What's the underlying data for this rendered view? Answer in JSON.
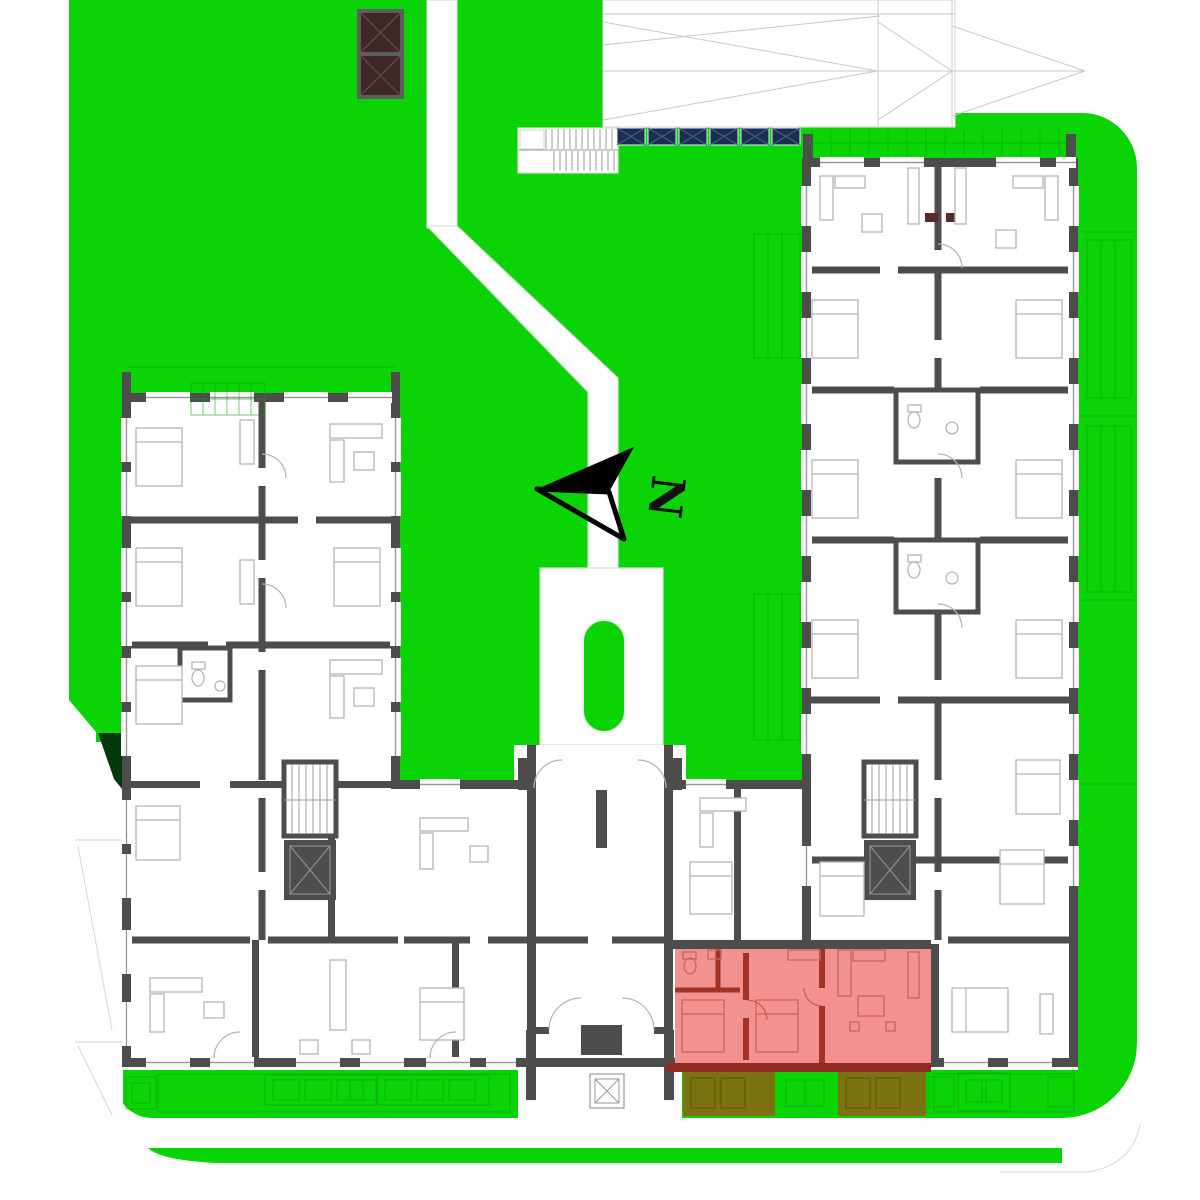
{
  "compass": {
    "label": "N",
    "direction": "pointing-left"
  },
  "highlighted_unit": {
    "highlighted": true,
    "rooms": [
      "bathroom",
      "bedroom",
      "bedroom",
      "living-room"
    ],
    "terrace_count": 2
  },
  "solar_panels": {
    "count": 6
  },
  "colors": {
    "lawn": "#0ad306",
    "lawnShadow": "#05380a",
    "hedgeLine": "#0a9e0a",
    "pathOutline": "#dcdcdc",
    "roofOutline": "#c9c9c9",
    "wall": "#4d4d4d",
    "furniture": "#b5b5b5",
    "sill": "#9a9a9a",
    "solarPanel": "#1a2e4f",
    "solarPanelLine": "#41608a",
    "roofHatch": "#3f2727",
    "roofHatchLine": "#6e4d4d",
    "roofHatchFrame": "#5d5d5d",
    "unitFill": "#f19190",
    "unitWall": "#a03226",
    "unitBalcony": "#8f2a20",
    "unitFurniture": "#c9655c",
    "terrace": "#7c7212",
    "terraceLine": "#5f580e"
  }
}
